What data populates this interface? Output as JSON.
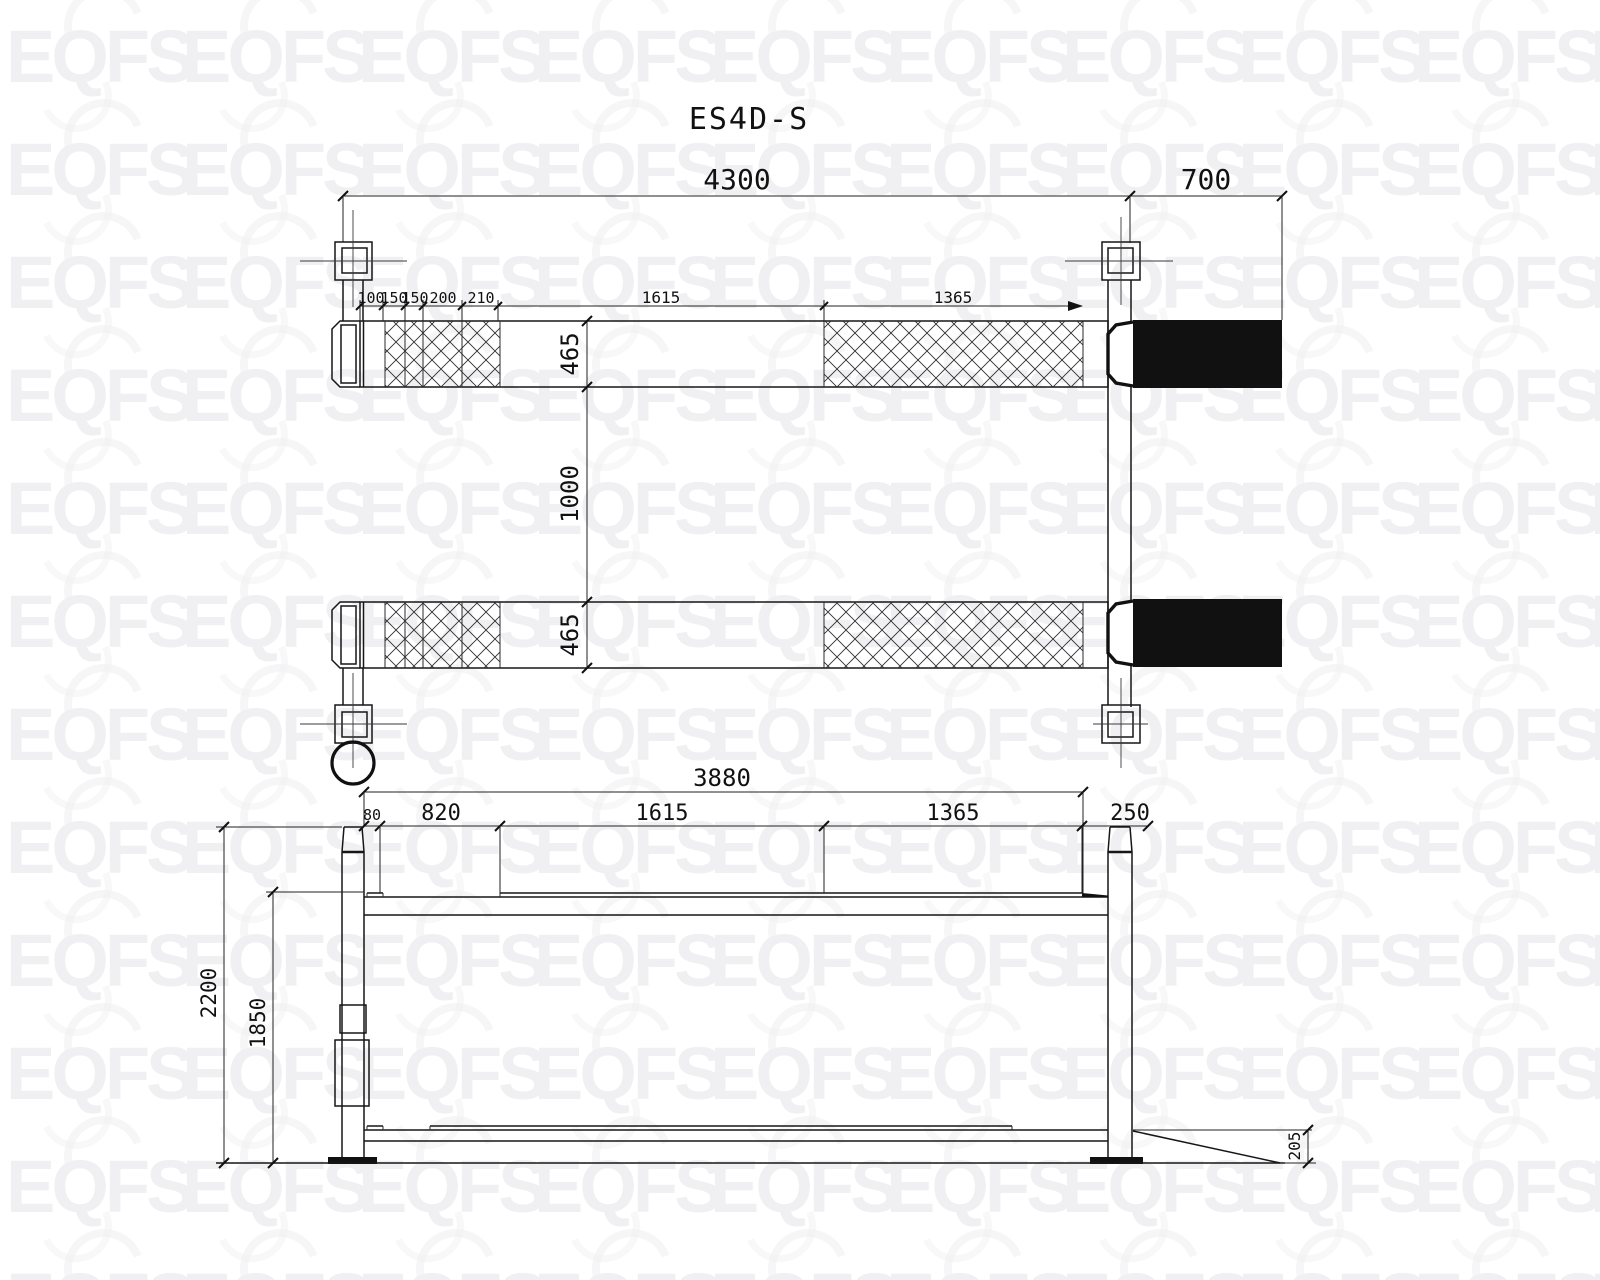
{
  "title": "ES4D-S",
  "watermark": {
    "text": "EQFS",
    "color": "#f0f0f2",
    "cols": 10,
    "rows": 12,
    "cell_w": 176,
    "cell_h": 113,
    "x0": 6,
    "y0": 20
  },
  "plan_view": {
    "overall_length": "4300",
    "ramp_extension": "700",
    "chain_segments": {
      "c100": "100",
      "c150a": "150",
      "c150b": "150",
      "c200": "200",
      "c210": "210"
    },
    "mid_section": "1615",
    "rear_tread_section": "1365",
    "runway_width_front": "465",
    "runway_gap": "1000",
    "runway_width_rear": "465"
  },
  "side_view": {
    "wheelbase_overall": "3880",
    "s80": "80",
    "s820": "820",
    "s1615": "1615",
    "s1365": "1365",
    "s250": "250",
    "overall_height": "2200",
    "clearance_height": "1850",
    "ramp_height": "205"
  }
}
